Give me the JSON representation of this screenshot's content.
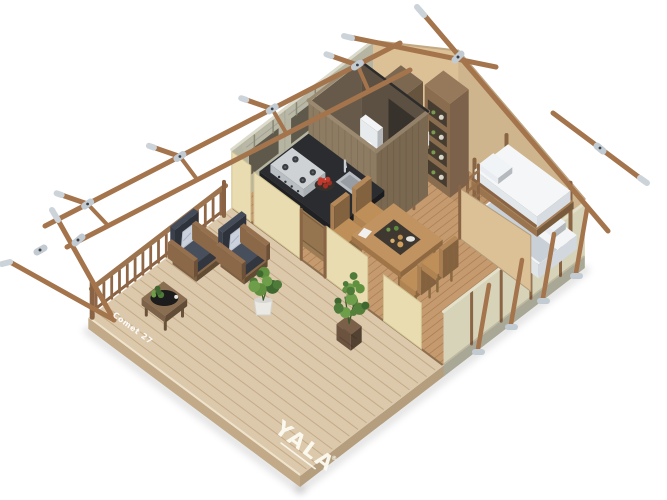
{
  "meta": {
    "title": "Safari glamping tent - 3D isometric cutaway render",
    "render_type": "architectural product visualization",
    "background": "#ffffff"
  },
  "branding": {
    "logo_text": "YALA",
    "registered_mark": "®",
    "model_label": "Comet 27"
  },
  "scene": {
    "items": [
      "wood-deck",
      "deck-railing",
      "lounge-armchairs",
      "throw-pillows",
      "coffee-table",
      "potted-plants",
      "kitchen-block",
      "gas-stove",
      "kitchen-sink",
      "fruit-bowl",
      "bathroom-cubicle",
      "toilet",
      "shower-screen",
      "dining-table",
      "dining-chairs",
      "food-platter",
      "storage-shelves",
      "single-bed",
      "double-bed",
      "bunk-bed",
      "bunk-ladder",
      "canvas-side-walls",
      "rear-gable-wall",
      "front-canvas-panels",
      "window-openings",
      "rolled-window-flaps",
      "wood-pole-frame",
      "metal-connectors"
    ]
  },
  "colors": {
    "background": "#ffffff",
    "deck_wood": "#dcc8ab",
    "deck_gap": "#c3ab89",
    "deck_side": "#c2aa88",
    "floor_wood": "#c59a6e",
    "floor_gap": "#ab8157",
    "pole_wood": "#a4744c",
    "metal": "#ccd4da",
    "metal_dark": "#3c4044",
    "canvas_sage": "#b6b5a2",
    "canvas_sage_light": "#dbdacb",
    "canvas_tan": "#dcc096",
    "canvas_cream": "#e9dcb0",
    "canvas_inner": "#d7d3b9",
    "dark_wood": "#8d7b62",
    "frame_wood": "#8a6545",
    "counter": "#232528",
    "stove": "#c6cacd",
    "bedding": "#f2f4f6",
    "cushion": "#3f4551",
    "pillow": "#ccd2dd",
    "plant_dark": "#4e7a3a",
    "plant_light": "#6f9e4b",
    "table_wood": "#b78c5c",
    "apple": "#c23b2e",
    "logo_white": "#fdfbf2"
  }
}
